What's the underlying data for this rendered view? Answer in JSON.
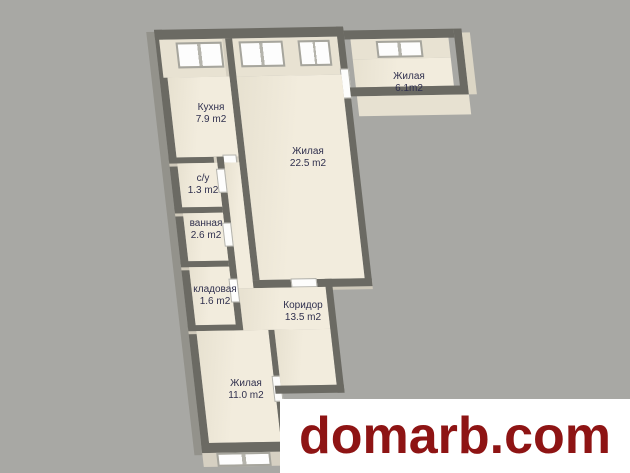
{
  "canvas": {
    "width": 630,
    "height": 473,
    "background": "#a8a8a4"
  },
  "floorplan": {
    "rooms": [
      {
        "name": "Кухня",
        "area": "7.9 m2"
      },
      {
        "name": "Жилая",
        "area": "22.5 m2"
      },
      {
        "name": "Жилая",
        "area": "6.1m2"
      },
      {
        "name": "с/у",
        "area": "1.3 m2"
      },
      {
        "name": "ванная",
        "area": "2.6 m2"
      },
      {
        "name": "кладовая",
        "area": "1.6 m2"
      },
      {
        "name": "Коридор",
        "area": "13.5 m2"
      },
      {
        "name": "Жилая",
        "area": "11.0 m2"
      }
    ],
    "colors": {
      "wall": "#6b6a63",
      "floor": "#f1ebdc",
      "wall_face": "#e8e2d2",
      "label_text": "#30304e"
    }
  },
  "watermark": {
    "text": "domarb.com",
    "text_color": "#8e1414",
    "background": "#ffffff"
  }
}
